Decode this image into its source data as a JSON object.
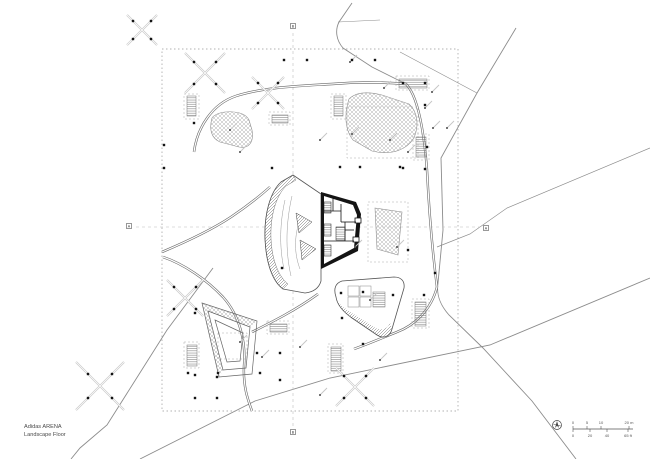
{
  "title_block": {
    "line1": "Adidas ARENA",
    "line2": "Landscape Floor"
  },
  "colors": {
    "paper": "#ffffff",
    "ink": "#141414",
    "line": "#555555",
    "road": "#8c8c8c",
    "faint": "#c4c4c4",
    "hatch": "#8f8f8f",
    "frame": "#aaaaaa",
    "text": "#4a4a4a"
  },
  "scale_bar": {
    "x": 573,
    "y": 429,
    "length": 60,
    "m_ticks": [
      [
        0,
        "0"
      ],
      [
        14,
        "5"
      ],
      [
        28,
        "10"
      ],
      [
        56,
        "20 m"
      ]
    ],
    "ft_ticks": [
      [
        0,
        "0"
      ],
      [
        17,
        "20"
      ],
      [
        34,
        "40"
      ],
      [
        55,
        "65 ft"
      ]
    ]
  },
  "section_markers": [
    {
      "label": "B",
      "x": 293,
      "y": 26
    },
    {
      "label": "A",
      "x": 129,
      "y": 226
    },
    {
      "label": "A",
      "x": 486,
      "y": 228
    },
    {
      "label": "B",
      "x": 293,
      "y": 432
    }
  ],
  "plan": {
    "boundary": {
      "x": 162,
      "y": 49,
      "w": 296,
      "h": 362
    },
    "section_lines": [
      "M293,33 L293,427",
      "M136,227 L480,227"
    ],
    "roads": [
      {
        "d": "M352,3 L339,22 C335,30 336,40 343,48 L372,67 L406,84",
        "w": 0.9
      },
      {
        "d": "M400,52 L477,93",
        "w": 0.6
      },
      {
        "d": "M516,28 L477,93 L441,158 L443,230 L438,283 C436,296 441,306 449,315 L483,348 L532,401 L576,459",
        "w": 0.9
      },
      {
        "d": "M650,148 L507,208 L470,234 L437,247",
        "w": 0.7
      },
      {
        "d": "M650,278 L490,345 L330,378 L255,401 L140,459",
        "w": 0.9
      },
      {
        "d": "M213,268 L167,330 L107,425 L80,448 L71,459",
        "w": 0.9
      },
      {
        "d": "M338,22 L380,20",
        "w": 0.5
      }
    ],
    "walkways": [
      "M194,152 C197,128 212,104 236,96 C264,87 300,86 332,84 C356,82 382,82 406,84 C418,96 424,132 427,170 C429,210 433,256 437,287",
      "M162,252 C188,241 213,229 231,217 C249,205 261,195 270,187",
      "M163,257 C184,264 207,280 223,297 C240,316 246,342 244,366 C243,387 248,400 252,411",
      "M437,287 C431,311 413,326 397,332 C382,338 368,344 354,349",
      "M252,332 C272,322 296,310 318,294"
    ],
    "hatches": [
      "M212,118 C209,129 211,138 220,142 L239,147 C250,149 254,141 252,130 L249,120 C246,113 235,111 225,112 C218,113 214,115 212,118 Z",
      "M349,99 C344,115 345,130 353,140 L372,151 C393,156 407,149 414,138 C419,126 418,112 409,104 L382,95 C366,91 355,93 349,99 Z",
      "M375,208 L402,212 L398,255 L377,249 Z"
    ],
    "frames": [
      [
        347,
        107,
        71,
        51
      ],
      [
        368,
        202,
        40,
        60
      ],
      [
        218,
        333,
        29,
        26
      ],
      [
        412,
        299,
        17,
        29
      ],
      [
        184,
        94,
        15,
        25
      ],
      [
        331,
        94,
        15,
        25
      ],
      [
        396,
        76,
        33,
        14
      ],
      [
        413,
        134,
        16,
        26
      ],
      [
        269,
        112,
        21,
        13
      ],
      [
        267,
        321,
        22,
        13
      ],
      [
        184,
        342,
        15,
        26
      ],
      [
        328,
        344,
        15,
        29
      ]
    ],
    "stairs": [
      [
        187,
        96,
        9,
        20
      ],
      [
        334,
        96,
        9,
        20
      ],
      [
        416,
        137,
        10,
        20
      ],
      [
        399,
        79,
        28,
        9
      ],
      [
        272,
        115,
        16,
        8
      ],
      [
        415,
        302,
        11,
        24
      ],
      [
        187,
        345,
        10,
        21
      ],
      [
        331,
        347,
        10,
        24
      ],
      [
        270,
        324,
        17,
        8
      ]
    ],
    "dots": [
      [
        272,
        168
      ],
      [
        340,
        167
      ],
      [
        360,
        167
      ],
      [
        400,
        167
      ],
      [
        403,
        83
      ],
      [
        425,
        83
      ],
      [
        425,
        105
      ],
      [
        427,
        147
      ],
      [
        403,
        168
      ],
      [
        425,
        169
      ],
      [
        282,
        268
      ],
      [
        408,
        250
      ],
      [
        424,
        295
      ],
      [
        435,
        273
      ],
      [
        341,
        293
      ],
      [
        363,
        292
      ],
      [
        393,
        295
      ],
      [
        342,
        318
      ],
      [
        363,
        344
      ],
      [
        195,
        313
      ],
      [
        257,
        353
      ],
      [
        280,
        353
      ],
      [
        195,
        375
      ],
      [
        217,
        377
      ],
      [
        195,
        398
      ],
      [
        217,
        398
      ],
      [
        260,
        373
      ],
      [
        280,
        380
      ],
      [
        188,
        373
      ],
      [
        218,
        373
      ],
      [
        284,
        60
      ],
      [
        307,
        60
      ],
      [
        352,
        60
      ],
      [
        375,
        60
      ],
      [
        164,
        145
      ],
      [
        164,
        168
      ],
      [
        194,
        123
      ]
    ],
    "ticks": [
      [
        350,
        62
      ],
      [
        384,
        88
      ],
      [
        425,
        108
      ],
      [
        433,
        128
      ],
      [
        408,
        152
      ],
      [
        390,
        140
      ],
      [
        240,
        152
      ],
      [
        352,
        134
      ],
      [
        355,
        247
      ],
      [
        397,
        247
      ],
      [
        240,
        342
      ],
      [
        262,
        357
      ],
      [
        300,
        347
      ],
      [
        370,
        300
      ],
      [
        447,
        128
      ],
      [
        320,
        140
      ],
      [
        230,
        130
      ],
      [
        320,
        395
      ],
      [
        380,
        360
      ],
      [
        432,
        92
      ]
    ],
    "trees": [
      {
        "cx": 205,
        "cy": 73,
        "r": 20,
        "d": 11
      },
      {
        "cx": 268,
        "cy": 93,
        "r": 16,
        "d": 10
      },
      {
        "cx": 185,
        "cy": 298,
        "r": 18,
        "d": 11
      },
      {
        "cx": 100,
        "cy": 386,
        "r": 24,
        "d": 12
      },
      {
        "cx": 355,
        "cy": 387,
        "r": 19,
        "d": 11
      },
      {
        "cx": 142,
        "cy": 30,
        "r": 15,
        "d": 9
      }
    ],
    "building": {
      "envelope": "M293,175 L281,182 C270,192 264,215 265,239 C266,262 272,281 283,289 L305,293 C314,292 319,288 321,281 L321,194 Z",
      "facade_band": "M293,175 L281,182 C270,192 264,215 265,239 C266,262 272,281 283,289 L288,284 C279,277 272,261 271,239 C270,216 276,196 286,186 L296,180 Z",
      "core_black": "M321,192 L356,202 L361,214 L358,251 L321,269 Z",
      "core_white": "M324,196 L353,205 L357,215 L354,248 L324,264 Z",
      "core_lines": [
        "M324,211 L341,211",
        "M341,204 L341,222",
        "M341,222 L356,222",
        "M345,222 L345,241",
        "M324,241 L354,241",
        "M333,196 L333,211",
        "M345,230 L354,230"
      ],
      "core_stripe_rects": [
        [
          324,
          202,
          7,
          11
        ],
        [
          324,
          224,
          7,
          12
        ],
        [
          324,
          245,
          7,
          11
        ],
        [
          336,
          227,
          9,
          13
        ]
      ],
      "notches": [
        [
          355,
          218,
          6,
          5
        ],
        [
          353,
          237,
          6,
          5
        ]
      ],
      "triangles": [
        "M296,213 L312,222 L299,233 Z",
        "M300,240 L316,249 L302,260 Z"
      ],
      "contours": [
        "M285,200 C280,222 279,246 284,269",
        "M292,196 C286,222 285,250 291,276",
        "M298,226 C294,241 295,256 300,269"
      ]
    },
    "ramp": {
      "outer": "M202,303 L257,321 L252,374 L219,377 Z",
      "mid": "M208,311 L250,327 L246,368 L223,370 Z",
      "inner": "M215,320 L243,333 L240,361 L227,362 Z",
      "bands": [
        "M202,303 L257,321 L250,327 L209,312 Z",
        "M202,303 L209,312 L223,370 L219,377 Z"
      ]
    },
    "pavilion": {
      "outline": "M336,297 C333,288 336,283 342,281 L394,277 C401,277 405,281 404,288 L392,329 C390,337 383,339 377,335 L352,318 C342,311 337,304 336,297 Z",
      "band": "M337,301 C340,309 346,314 353,319 L377,335 C383,339 390,337 392,329 L390,323 C387,330 380,331 374,327 L352,313 C344,308 340,305 337,301 Z",
      "inner_rects": [
        [
          348,
          286,
          11,
          10
        ],
        [
          360,
          286,
          11,
          10
        ],
        [
          348,
          297,
          11,
          10
        ],
        [
          360,
          297,
          11,
          10
        ]
      ],
      "stripe_rect": [
        373,
        292,
        12,
        15
      ]
    }
  }
}
